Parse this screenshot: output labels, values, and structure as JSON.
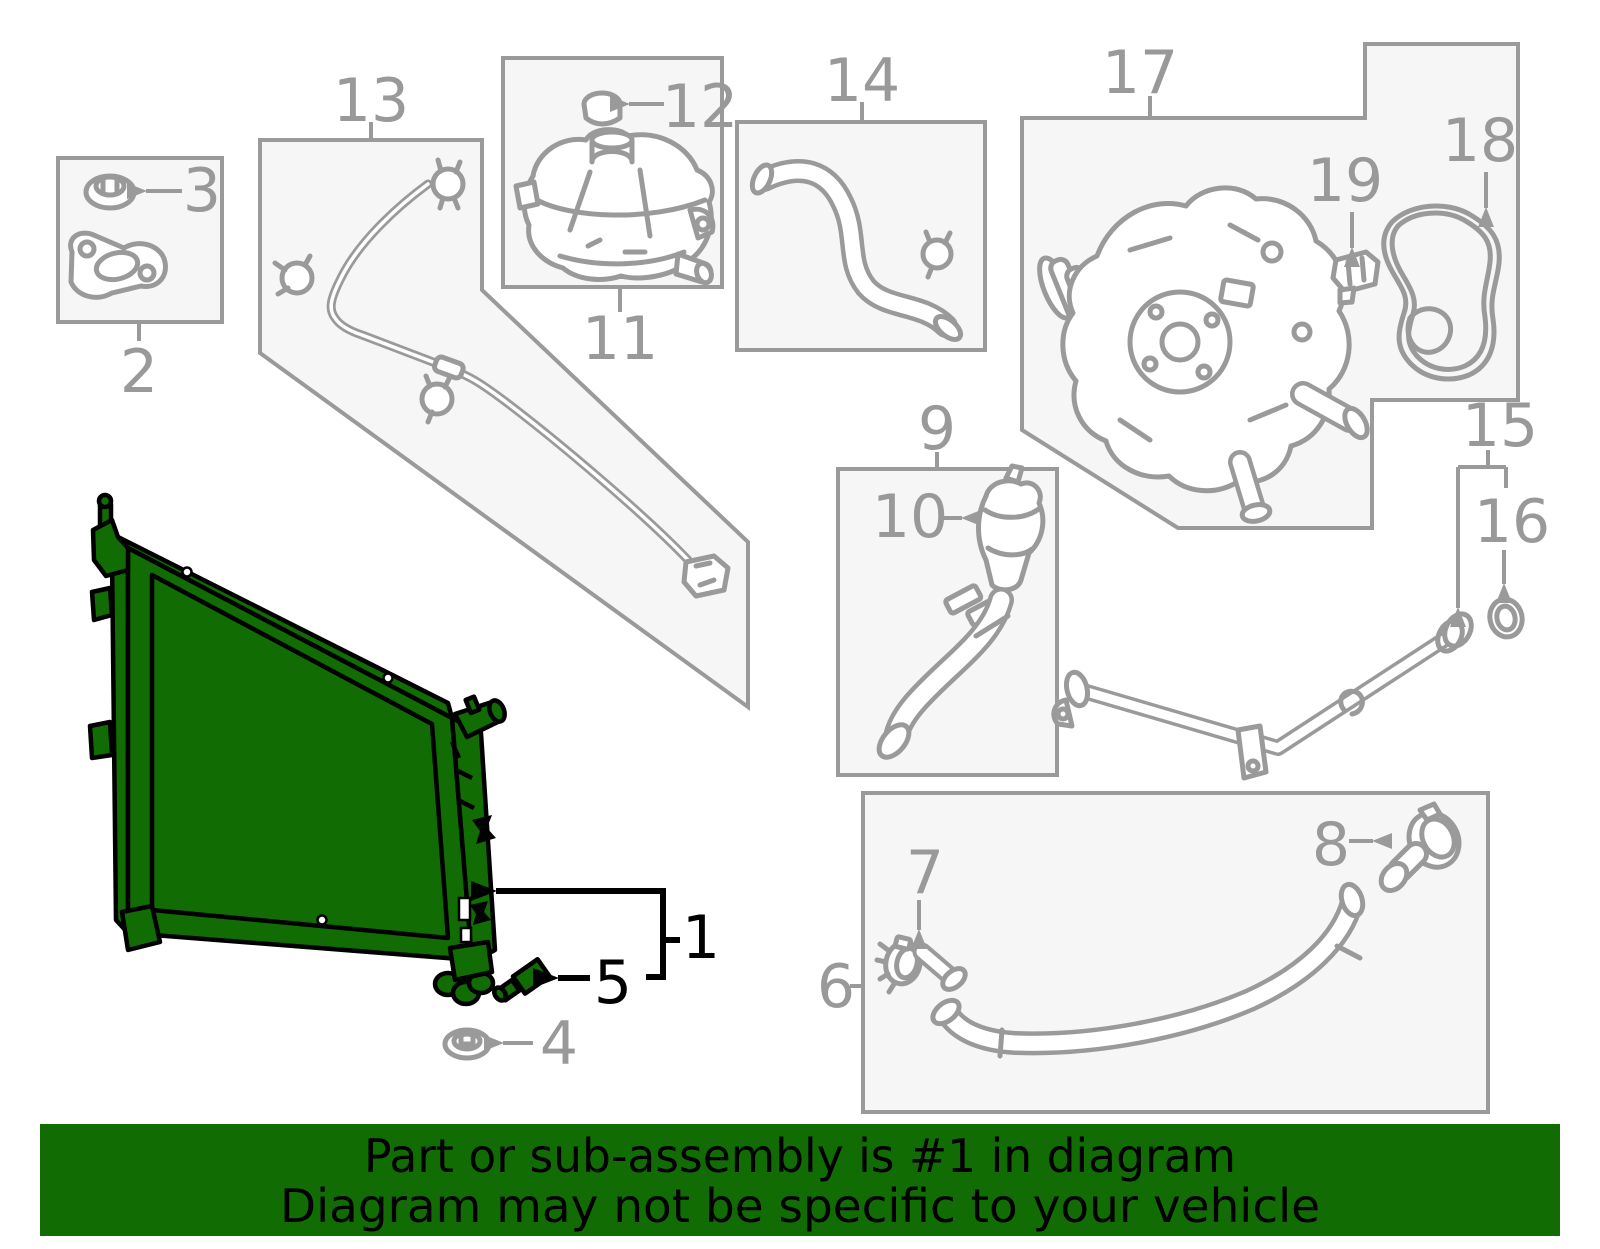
{
  "banner": {
    "line1": "Part or sub-assembly is #1 in diagram",
    "line2": "Diagram may not be specific to your vehicle"
  },
  "highlighted_part_number": "1",
  "colors": {
    "highlight_green": "#116C04",
    "line_gray": "#9A9A9A",
    "label_gray": "#999999",
    "box_fill": "#F6F6F6",
    "callout_black": "#000000",
    "background": "#FFFFFF"
  },
  "callouts": {
    "1": "1",
    "2": "2",
    "3": "3",
    "4": "4",
    "5": "5",
    "6": "6",
    "7": "7",
    "8": "8",
    "9": "9",
    "10": "10",
    "11": "11",
    "12": "12",
    "13": "13",
    "14": "14",
    "15": "15",
    "16": "16",
    "17": "17",
    "18": "18",
    "19": "19"
  }
}
